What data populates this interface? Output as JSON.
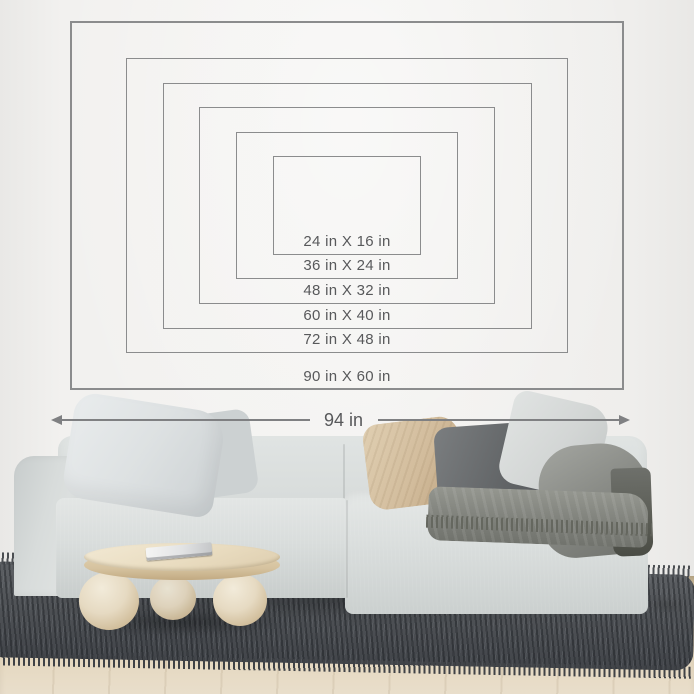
{
  "size_chart": {
    "sizes": [
      {
        "label": "24 in X 16 in",
        "width_in": 24,
        "height_in": 16
      },
      {
        "label": "36 in X 24 in",
        "width_in": 36,
        "height_in": 24
      },
      {
        "label": "48 in X 32 in",
        "width_in": 48,
        "height_in": 32
      },
      {
        "label": "60 in X 40 in",
        "width_in": 60,
        "height_in": 40
      },
      {
        "label": "72 in X 48 in",
        "width_in": 72,
        "height_in": 48
      },
      {
        "label": "90 in X 60 in",
        "width_in": 90,
        "height_in": 60
      }
    ],
    "line_color": "#8b8c8d",
    "label_color": "#58595b"
  },
  "measurement": {
    "label": "94 in",
    "arrow_color": "#7f8082"
  },
  "scene_colors": {
    "wall": "#f1f0ee",
    "sofa": "#d8dcdb",
    "pillow_beige": "#d0b998",
    "pillow_dark": "#626568",
    "throw": "#85877f",
    "table_wood": "#e8dcc0",
    "rug": "#505357",
    "floor_wood": "#dfd1b3"
  }
}
